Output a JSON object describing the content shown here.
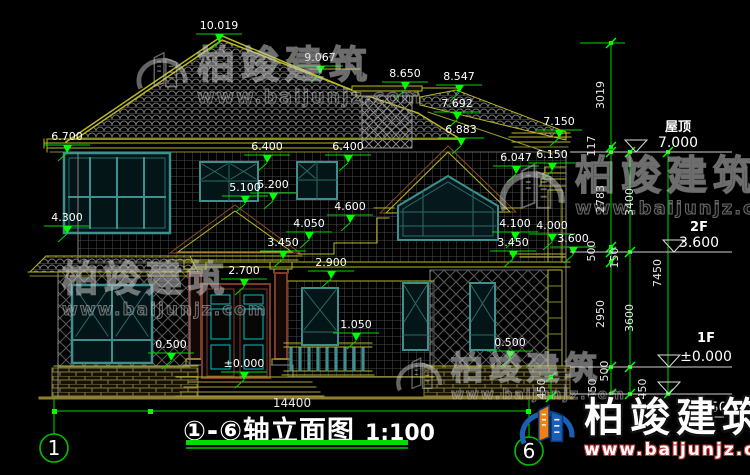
{
  "drawing_title": {
    "label": "①-⑥轴立面图",
    "scale": "1:100"
  },
  "axis_bubbles": {
    "left": "1",
    "right": "6"
  },
  "bottom_dim": {
    "value": "14400"
  },
  "watermark_brand": {
    "name": "柏竣建筑",
    "url": "www.baijunjz.com"
  },
  "colors": {
    "background": "#000000",
    "dim_green": "#00d800",
    "bright_green": "#00ff00",
    "trim_yellow": "#b9b925",
    "window_teal": "#3f8f8f",
    "door_cyan": "#00c0c0",
    "frame_maroon": "#7a3b2b",
    "text_white": "#ffffff",
    "logo_blue": "#1a5fb4",
    "logo_orange": "#f08010"
  },
  "dim_markers": [
    {
      "t": "10.019",
      "x": 219,
      "y": 29
    },
    {
      "t": "9.067",
      "x": 320,
      "y": 61
    },
    {
      "t": "8.650",
      "x": 405,
      "y": 77
    },
    {
      "t": "8.547",
      "x": 459,
      "y": 80
    },
    {
      "t": "7.692",
      "x": 457,
      "y": 107
    },
    {
      "t": "7.150",
      "x": 559,
      "y": 125
    },
    {
      "t": "6.883",
      "x": 461,
      "y": 133
    },
    {
      "t": "6.700",
      "x": 67,
      "y": 140
    },
    {
      "t": "6.400",
      "x": 267,
      "y": 150
    },
    {
      "t": "6.400",
      "x": 348,
      "y": 150
    },
    {
      "t": "6.150",
      "x": 552,
      "y": 158
    },
    {
      "t": "6.047",
      "x": 516,
      "y": 161
    },
    {
      "t": "5.100",
      "x": 245,
      "y": 191
    },
    {
      "t": "5.200",
      "x": 273,
      "y": 188
    },
    {
      "t": "4.600",
      "x": 350,
      "y": 210
    },
    {
      "t": "4.300",
      "x": 67,
      "y": 221
    },
    {
      "t": "4.100",
      "x": 515,
      "y": 227
    },
    {
      "t": "4.000",
      "x": 552,
      "y": 229
    },
    {
      "t": "4.050",
      "x": 309,
      "y": 227
    },
    {
      "t": "3.450",
      "x": 283,
      "y": 246
    },
    {
      "t": "3.450",
      "x": 513,
      "y": 246
    },
    {
      "t": "3.600",
      "x": 573,
      "y": 242
    },
    {
      "t": "2.900",
      "x": 331,
      "y": 266
    },
    {
      "t": "2.700",
      "x": 244,
      "y": 274
    },
    {
      "t": "1.050",
      "x": 356,
      "y": 328
    },
    {
      "t": "0.500",
      "x": 171,
      "y": 348
    },
    {
      "t": "0.500",
      "x": 510,
      "y": 346
    },
    {
      "t": "±0.000",
      "x": 244,
      "y": 367
    }
  ],
  "chain_labels": [
    {
      "t": "3019",
      "x": 604,
      "y": 95
    },
    {
      "t": "117",
      "x": 595,
      "y": 146
    },
    {
      "t": "2783",
      "x": 604,
      "y": 199
    },
    {
      "t": "3400",
      "x": 633,
      "y": 202
    },
    {
      "t": "500",
      "x": 595,
      "y": 251
    },
    {
      "t": "150",
      "x": 618,
      "y": 258
    },
    {
      "t": "2950",
      "x": 604,
      "y": 314
    },
    {
      "t": "3600",
      "x": 633,
      "y": 318
    },
    {
      "t": "7450",
      "x": 661,
      "y": 273
    },
    {
      "t": "500",
      "x": 608,
      "y": 371
    },
    {
      "t": "450",
      "x": 545,
      "y": 389
    },
    {
      "t": "450",
      "x": 596,
      "y": 389
    },
    {
      "t": "450",
      "x": 646,
      "y": 389
    }
  ],
  "chains": [
    {
      "x": 611,
      "y1": 43,
      "y2": 394,
      "ticks": [
        43,
        147,
        152,
        247,
        252,
        262,
        367,
        394
      ]
    },
    {
      "x": 630,
      "y1": 152,
      "y2": 394,
      "ticks": [
        152,
        252,
        367,
        394
      ]
    },
    {
      "x": 668,
      "y1": 152,
      "y2": 394,
      "ticks": [
        152,
        394
      ]
    },
    {
      "x": 551,
      "y1": 377,
      "y2": 397,
      "ticks": [
        377,
        397
      ]
    }
  ],
  "level_markers_right": [
    {
      "name": "屋顶",
      "value": "7.000",
      "tx": 678,
      "ny": 131,
      "vy": 147,
      "line_y": 152,
      "tri_x": 636
    },
    {
      "name": "2F",
      "value": "3.600",
      "tx": 699,
      "ny": 231,
      "vy": 247,
      "line_y": 252,
      "tri_x": 674
    },
    {
      "name": "1F",
      "value": "±0.000",
      "tx": 706,
      "ny": 342,
      "vy": 361,
      "line_y": 367,
      "tri_x": 669
    },
    {
      "name": "",
      "value": "-0.450",
      "tx": 705,
      "ny": 0,
      "vy": 412,
      "line_y": 394,
      "tri_x": 669
    }
  ],
  "watermarks": [
    {
      "x": 133,
      "y": 46,
      "logo": 58,
      "ts": 38,
      "us": 19,
      "variant": "wm-grey"
    },
    {
      "x": 495,
      "y": 156,
      "logo": 74,
      "ts": 40,
      "us": 18,
      "variant": "wm-grey"
    },
    {
      "x": 62,
      "y": 262,
      "logo": 0,
      "ts": 36,
      "us": 17,
      "variant": "wm-grey"
    },
    {
      "x": 393,
      "y": 352,
      "logo": 52,
      "ts": 32,
      "us": 14,
      "variant": "wm-grey"
    },
    {
      "x": 516,
      "y": 398,
      "logo": 62,
      "ts": 40,
      "us": 17,
      "variant": "wm-solid"
    }
  ]
}
